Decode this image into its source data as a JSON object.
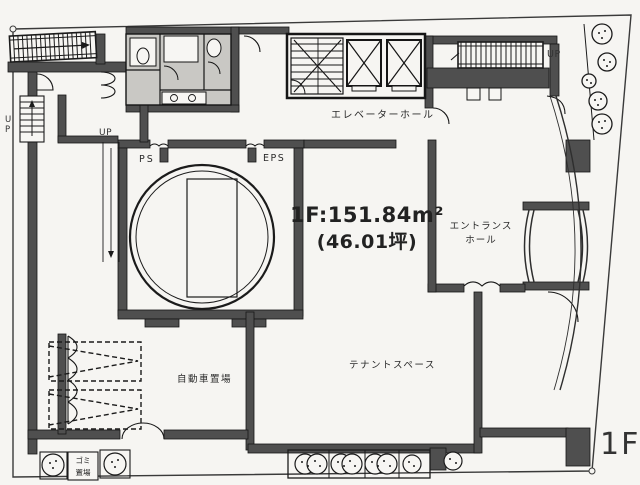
{
  "plan": {
    "floor_tag": "1F",
    "area": {
      "line1": "1F:151.84m²",
      "line2": "(46.01坪)"
    },
    "rooms": {
      "elevator_hall": "エレベーターホール",
      "entrance_hall": [
        "エントランス",
        "ホール"
      ],
      "tenant_space": "テナントスペース",
      "car_parking": "自動車置場",
      "garbage": [
        "ゴミ",
        "置場"
      ],
      "pipe_shaft": "PS",
      "electric_pipe_shaft": "EPS"
    },
    "stairs": {
      "up_top_left": "UP",
      "up_mid_left": "UP",
      "up_top_right": "UP"
    },
    "colors": {
      "wall": "#4f4f4f",
      "line": "#1b1b1b",
      "paper": "#f7f6f3",
      "room_gray": "#c9c8c4"
    }
  }
}
